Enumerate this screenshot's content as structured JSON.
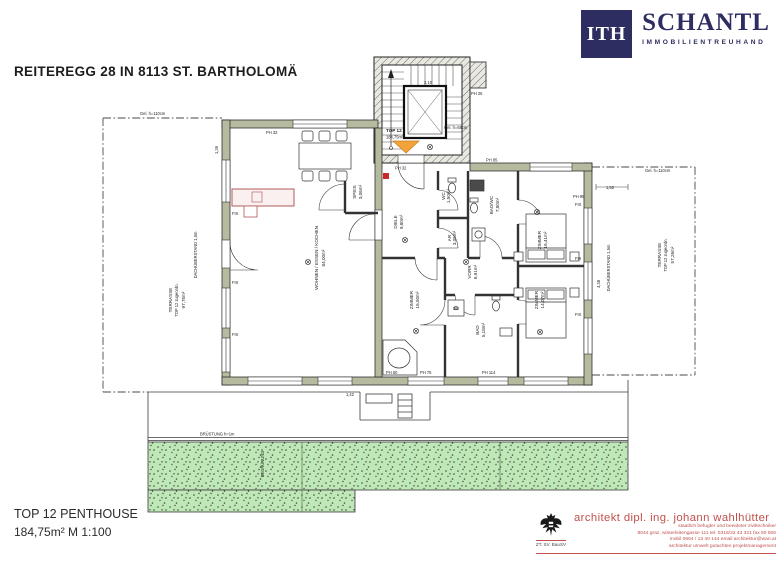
{
  "header": {
    "title": "REITEREGG 28 IN 8113 ST. BARTHOLOMÄ"
  },
  "logo": {
    "mark": "ITH",
    "name": "SCHANTL",
    "subtitle": "IMMOBILIENTREUHAND",
    "navy": "#2e2d62"
  },
  "title_block": {
    "name": "TOP 12 PENTHOUSE",
    "details": "184,75m²   M 1:100"
  },
  "architect": {
    "name": "architekt dipl. ing. johann wahlhütter",
    "line1": "staatlich befugter und beeideter ziviltechniker",
    "line2": "8044 graz, winterleitengasse 111   tel. 0316/32 43 321   fax 50 506",
    "line3": "mobil 0664 / 13 40 144       email architektur@wan.at",
    "line4": "architektur   umwelt   gutachten   projektmanagement",
    "stamp": "ZT. SV. BauSV",
    "accent": "#c0504d"
  },
  "plan": {
    "unit": {
      "label": "TOP 12",
      "area": "184,75m²"
    },
    "rooms": {
      "wohnen": {
        "name": "WOHNEN / ESSEN / KOCHEN",
        "area": "84,00m²"
      },
      "speis": {
        "name": "SPEIS",
        "area": "3,06m²"
      },
      "diele": {
        "name": "DIELE",
        "area": "9,80m²"
      },
      "wc": {
        "name": "WC",
        "area": "1,50m²"
      },
      "badwc": {
        "name": "BAD/WC",
        "area": "7,80m²"
      },
      "ar": {
        "name": "AR",
        "area": "3,05m²"
      },
      "vorr": {
        "name": "VORR",
        "area": "6,91m²"
      },
      "bad": {
        "name": "BAD",
        "area": "5,18m²"
      },
      "zimmer1": {
        "name": "ZIMMER",
        "area": "16,50m²"
      },
      "zimmer2": {
        "name": "ZIMMER",
        "area": "14,07m²"
      },
      "zimmer3": {
        "name": "ZIMMER",
        "area": "16,41m²"
      },
      "du": "DU"
    },
    "terraces": {
      "left": {
        "name": "TERRASSE",
        "sub": "TOP 12 zugeordn.",
        "area": "97,75m²"
      },
      "right": {
        "name": "TERRASSE",
        "sub": "TOP 12 zugeordn.",
        "area": "57,26m²"
      }
    },
    "annotations": {
      "dach_left": "DACHÜBERSTAND 1,5m",
      "dach_right": "DACHÜBERSTAND 1,5m",
      "bruestung": "BRÜSTUNG h=1m",
      "begruenung": "BEGRÜNUNG",
      "gel_left": "Gel. h=110cm",
      "gel_right": "Gel. h=110cm",
      "gel_mid": "Gel. h=68cm",
      "fix": "FIX",
      "ph32": "PH 32",
      "ph26": "PH 26",
      "ph85": "PH 85",
      "ph98": "PH 98",
      "ph60": "PH 60",
      "ph75": "PH 75",
      "ph114": "PH 114",
      "dim1": "1,36",
      "dim2": "2,10",
      "dim3": "1,50",
      "dim4": "4,38",
      "dim5": "1,42"
    }
  }
}
